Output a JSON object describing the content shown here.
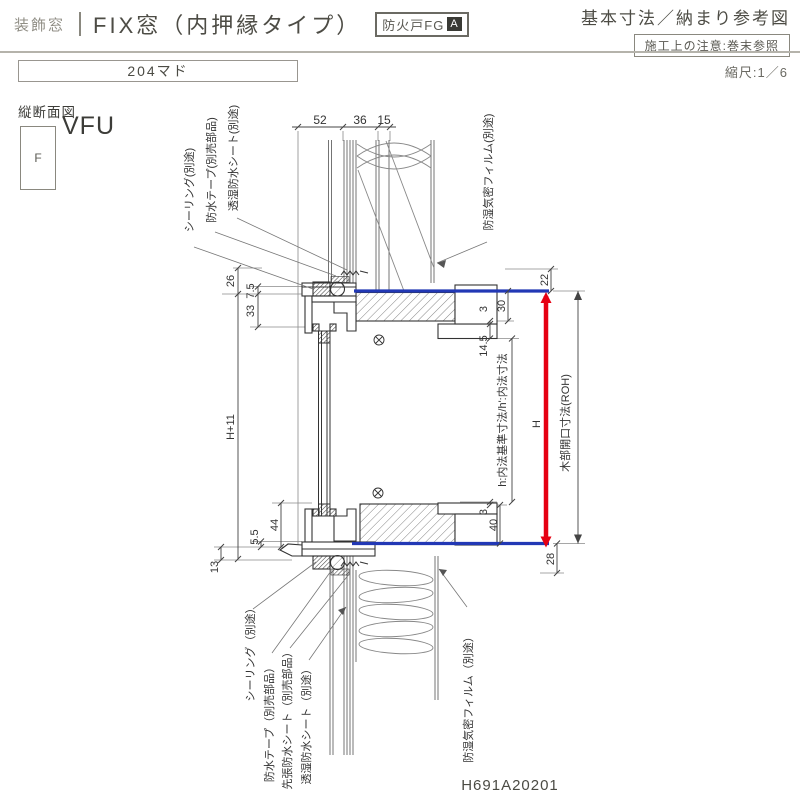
{
  "header": {
    "category": "装飾窓",
    "title": "FIX窓（内押縁タイプ）",
    "fire_badge_label": "防火戸FG",
    "fire_badge_grade": "A",
    "doc_type": "基本寸法／納まり参考図",
    "construction_note": "施工上の注意:巻末参照",
    "model_size": "204マド",
    "scale": "縮尺:1／6"
  },
  "drawing": {
    "view_label": "縦断面図",
    "frame_symbol": "F",
    "product_code": "VFU",
    "drawing_number": "H691A20201",
    "colors": {
      "dimension_blue": "#2238b5",
      "height_red": "#e60012"
    },
    "dims": {
      "top_52": "52",
      "top_36": "36",
      "top_15": "15",
      "left_26": "26",
      "left_7_5": "7.5",
      "left_33": "33",
      "left_h_plus_11": "H+11",
      "left_44": "44",
      "left_5_5": "5.5",
      "left_13": "13",
      "right_22": "22",
      "right_30": "30",
      "right_3_top": "3",
      "right_14_5": "14.5",
      "right_3_bottom": "3",
      "right_40": "40",
      "right_28": "28",
      "height": "H",
      "inner_height_label": "h:内法基準寸法/h':内法寸法",
      "rough_opening_label": "木部開口寸法(ROH)"
    },
    "callouts": {
      "top": [
        "シーリング(別途)",
        "防水テープ(別売部品)",
        "透湿防水シート(別途)",
        "防湿気密フィルム(別途)"
      ],
      "bottom": [
        "シーリング（別途）",
        "防水テープ（別売部品）",
        "先張防水シート（別売部品）",
        "透湿防水シート（別途）",
        "防湿気密フィルム（別途）"
      ]
    }
  }
}
